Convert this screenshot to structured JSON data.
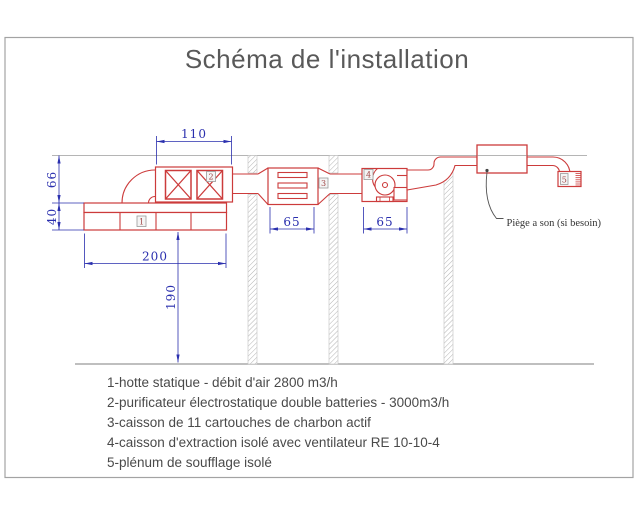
{
  "title": "Schéma de l'installation",
  "legend": {
    "items": [
      "1-hotte statique - débit d'air 2800 m3/h",
      "2-purificateur électrostatique double batteries - 3000m3/h",
      "3-caisson de 11 cartouches de charbon actif",
      "4-caisson d'extraction isolé avec ventilateur RE 10-10-4",
      "5-plénum de soufflage isolé"
    ]
  },
  "diagram": {
    "annotation": "Piège a son (si besoin)",
    "labels": {
      "hood": "1",
      "purifier": "2",
      "carbon": "3",
      "fan": "4",
      "plenum": "5"
    },
    "dims": {
      "purifier_width": "110",
      "duct_height": "66",
      "hood_height": "40",
      "hood_width": "200",
      "floor_height": "190",
      "carbon_width": "65",
      "fan_width": "65"
    },
    "colors": {
      "duct_red": "#cc3b3b",
      "dim_blue": "#2a2fae",
      "line_gray": "#b5b5b5",
      "text_gray": "#4a4a4a"
    }
  }
}
